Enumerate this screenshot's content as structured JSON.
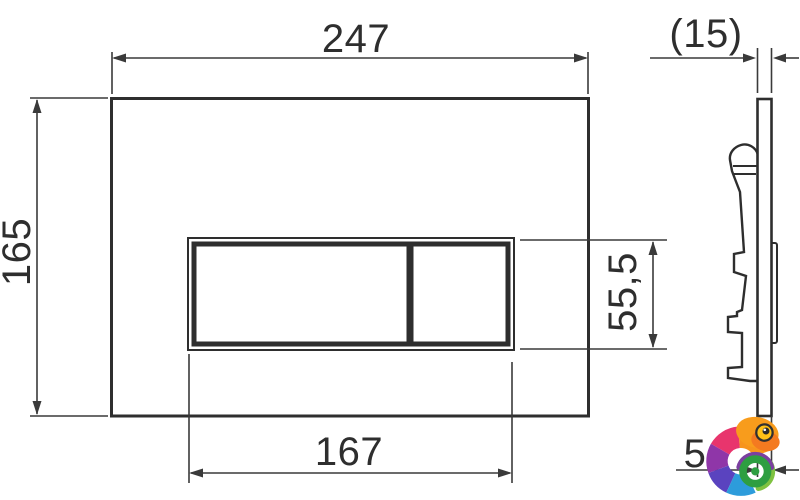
{
  "front_view": {
    "width_mm": "247",
    "height_mm": "165",
    "button_width_mm": "167",
    "button_height_mm": "55,5"
  },
  "side_view": {
    "depth_mm": "(15)",
    "thickness_mm": "5"
  },
  "watermark": {
    "icon": "chameleon-logo"
  },
  "colors": {
    "line": "#2e2e2e",
    "background": "#ffffff",
    "chameleon": {
      "orange": "#F7941D",
      "orange_dark": "#F47A20",
      "orange_light": "#F89C1C",
      "pink": "#E8356D",
      "purple": "#8F36A8",
      "crescent_purple": "#7B3FA0",
      "indigo": "#5A43BF",
      "blue": "#2D9CDB",
      "green": "#2E9E41",
      "light_green": "#7FC241",
      "eye_yellow": "#FFC117"
    }
  }
}
